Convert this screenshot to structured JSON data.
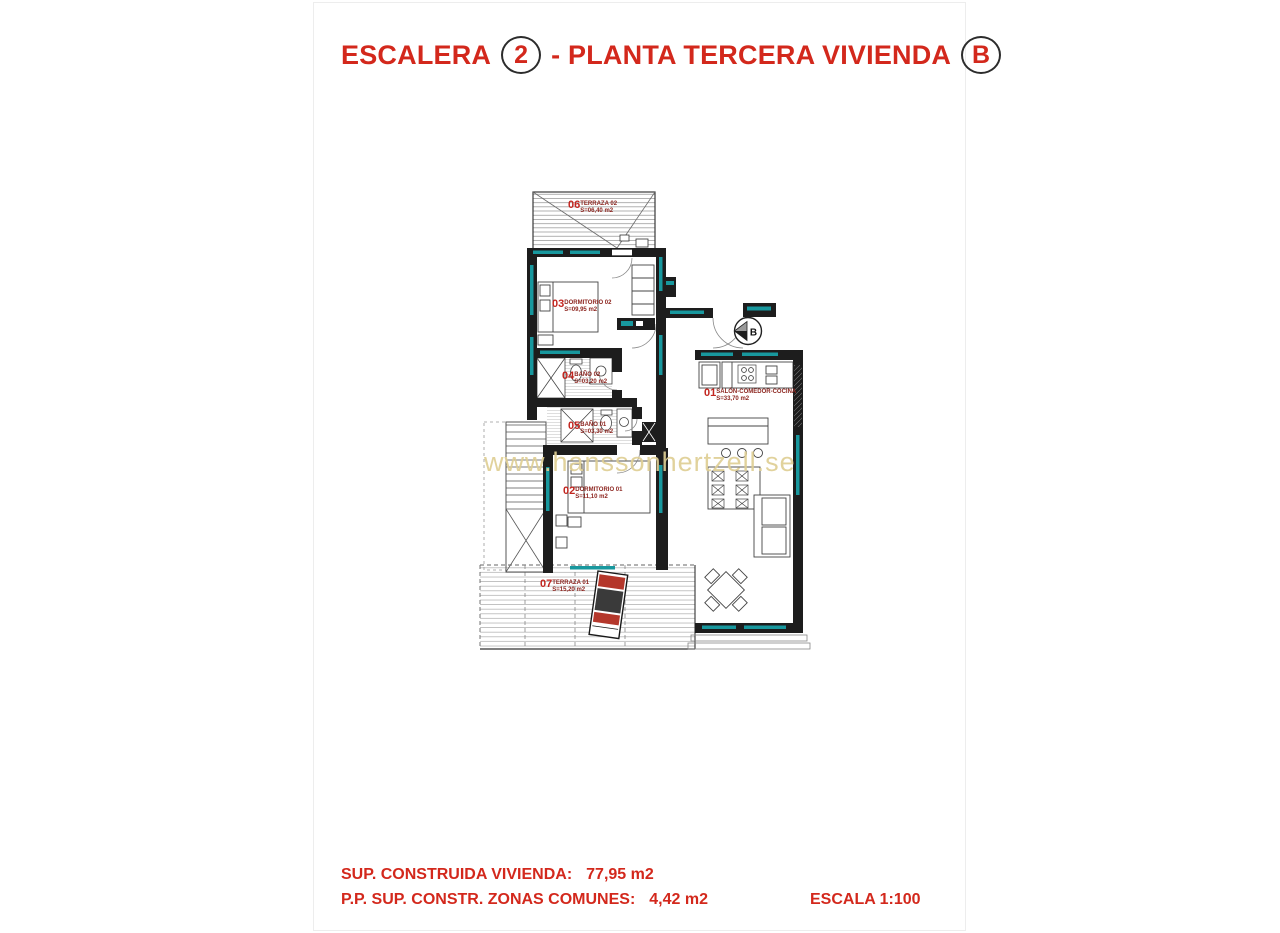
{
  "title": {
    "part1": "ESCALERA",
    "stair_number": "2",
    "part2": "- PLANTA TERCERA VIVIENDA",
    "unit_letter": "B"
  },
  "plan": {
    "marker_letter": "B",
    "rooms": [
      {
        "num": "06",
        "name": "TERRAZA 02",
        "area": "S=06,40 m2"
      },
      {
        "num": "03",
        "name": "DORMITORIO 02",
        "area": "S=09,95 m2"
      },
      {
        "num": "04",
        "name": "BAÑO 02",
        "area": "S=03,20 m2"
      },
      {
        "num": "05",
        "name": "BAÑO 01",
        "area": "S=03,30 m2"
      },
      {
        "num": "02",
        "name": "DORMITORIO 01",
        "area": "S=11,10 m2"
      },
      {
        "num": "01",
        "name": "SALÓN-COMEDOR-COCINA",
        "area": "S=33,70 m2"
      },
      {
        "num": "07",
        "name": "TERRAZA 01",
        "area": "S=15,20 m2"
      }
    ]
  },
  "watermark_text": "www.hanssonhertzell.se",
  "footer": {
    "line1_label": "SUP. CONSTRUIDA VIVIENDA:",
    "line1_value": "77,95 m2",
    "line2_label": "P.P. SUP. CONSTR. ZONAS COMUNES:",
    "line2_value": "4,42 m2",
    "scale": "ESCALA 1:100"
  },
  "colors": {
    "title_red": "#d3281c",
    "room_number_red": "#c2251f",
    "wall_black": "#1d1d1d",
    "accent_teal": "#18989e",
    "watermark": "#dece94"
  }
}
